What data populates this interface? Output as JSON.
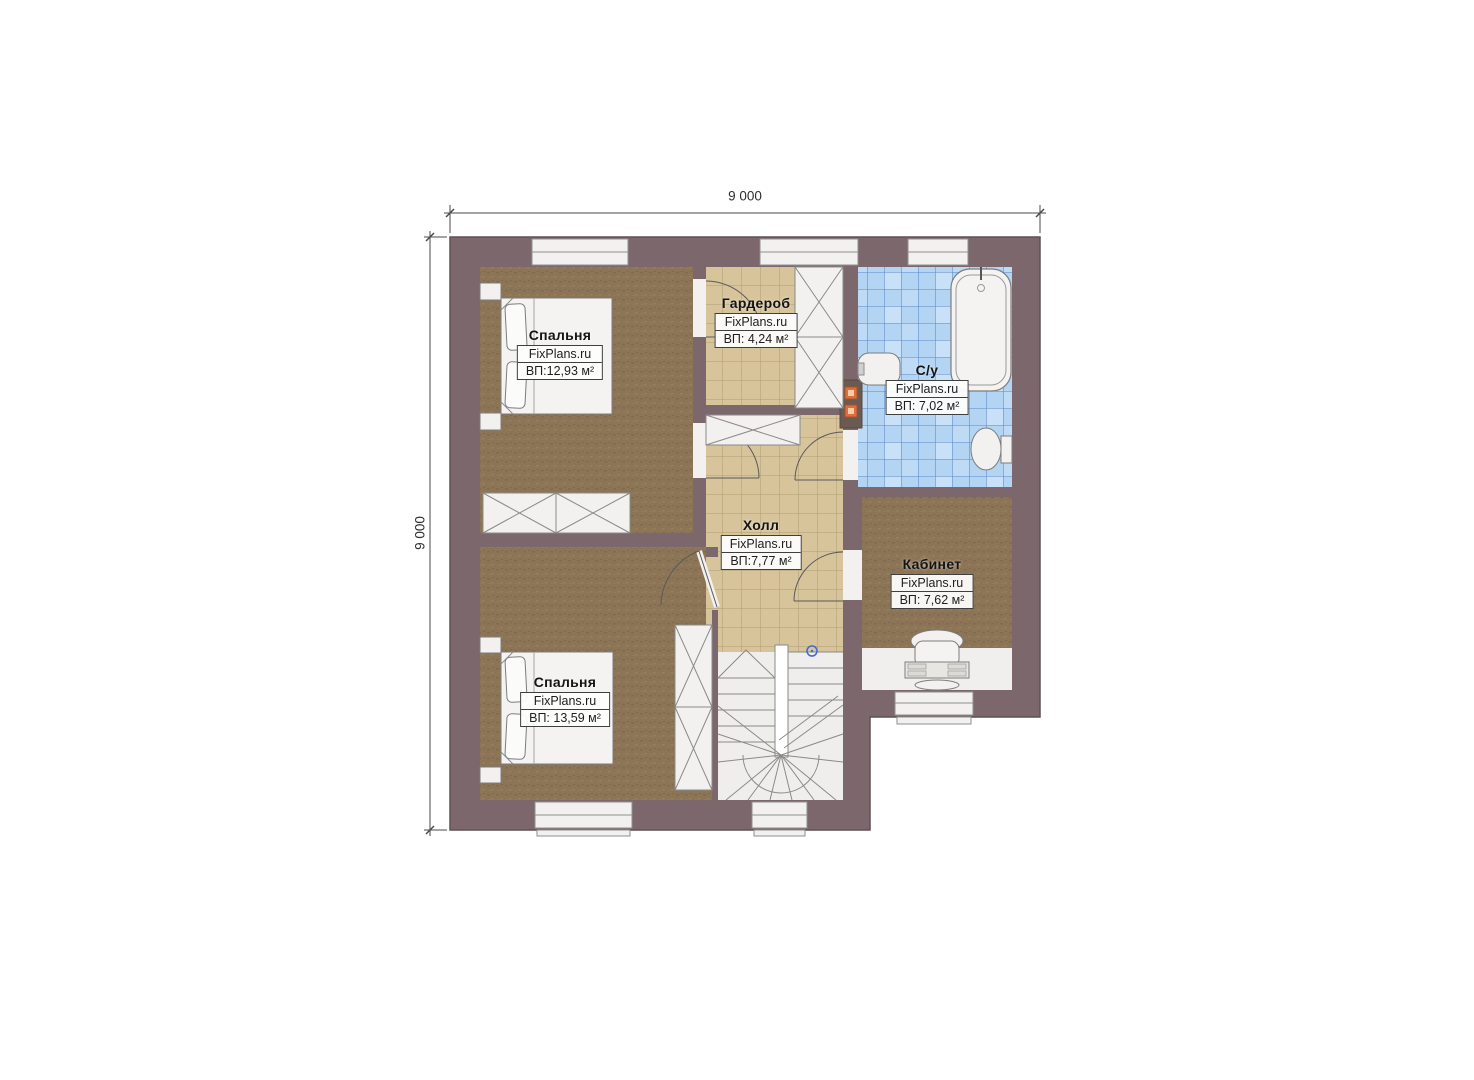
{
  "plan": {
    "dimensions": {
      "top": "9 000",
      "left": "9 000"
    },
    "watermark": "FixPlans.ru",
    "rooms": [
      {
        "id": "bedroom-1",
        "name": "Спальня",
        "watermark": "FixPlans.ru",
        "area": "ВП:12,93 м²"
      },
      {
        "id": "wardrobe",
        "name": "Гардероб",
        "watermark": "FixPlans.ru",
        "area": "ВП: 4,24 м²"
      },
      {
        "id": "bathroom",
        "name": "С/у",
        "watermark": "FixPlans.ru",
        "area": "ВП: 7,02 м²"
      },
      {
        "id": "hall",
        "name": "Холл",
        "watermark": "FixPlans.ru",
        "area": "ВП:7,77 м²"
      },
      {
        "id": "office",
        "name": "Кабинет",
        "watermark": "FixPlans.ru",
        "area": "ВП: 7,62 м²"
      },
      {
        "id": "bedroom-2",
        "name": "Спальня",
        "watermark": "FixPlans.ru",
        "area": "ВП: 13,59 м²"
      }
    ],
    "colors": {
      "wall": "#7c686c",
      "wood_floor": "#8c7456",
      "tile_floor": "#d7c49b",
      "tile_grid": "#ae9c72",
      "bath_tile": "#b3d4f2",
      "bath_grid": "#5b87c5",
      "vent_marker": "#de6f3c",
      "stair_marker": "#4169cf"
    }
  }
}
